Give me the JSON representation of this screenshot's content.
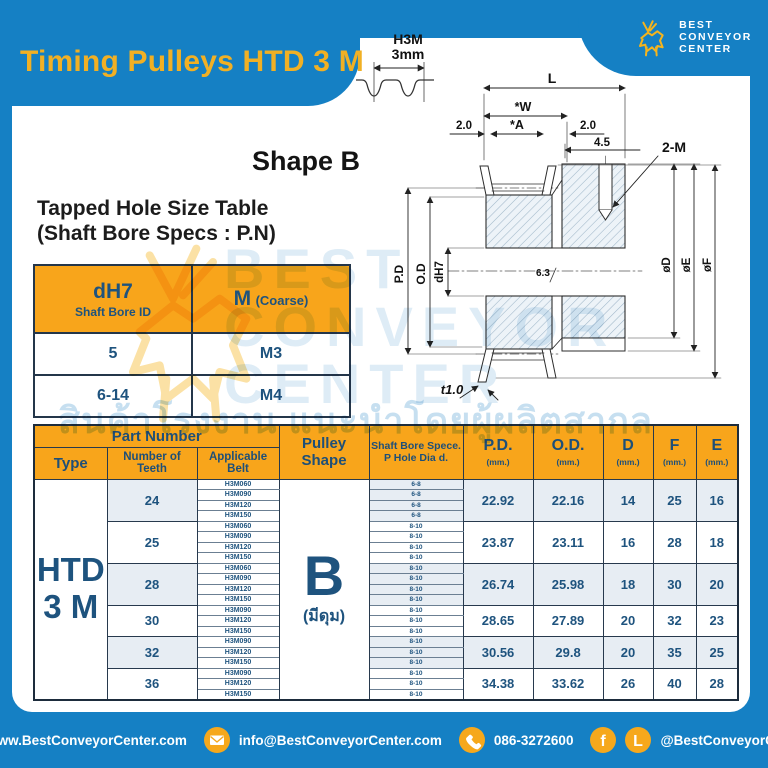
{
  "title": "Timing Pulleys HTD 3 M",
  "logo": {
    "line1": "BEST",
    "line2": "CONVEYOR",
    "line3": "CENTER"
  },
  "tooth_profile": {
    "type_label": "H3M",
    "pitch_label": "3mm"
  },
  "shape_heading": "Shape B",
  "tapped_hole_table": {
    "title1": "Tapped Hole Size Table",
    "title2": "(Shaft Bore Specs : P.N)",
    "col1_main": "dH7",
    "col1_sub": "Shaft Bore ID",
    "col2_main": "M",
    "col2_sub": "(Coarse)",
    "rows": [
      [
        "5",
        "M3"
      ],
      [
        "6-14",
        "M4"
      ]
    ]
  },
  "drawing": {
    "dim_L": "L",
    "dim_W": "*W",
    "dim_A": "*A",
    "dim_left": "2.0",
    "dim_right": "2.0",
    "dim_hub": "4.5",
    "tap_callout": "2-M",
    "pd": "P.D",
    "od": "O.D",
    "bore": "dH7",
    "surface": "6.3",
    "dia_d": "øD",
    "dia_e": "øE",
    "dia_f": "øF",
    "flange_t": "t1.0"
  },
  "main_table": {
    "header": {
      "part_number": "Part Number",
      "type": "Type",
      "teeth": "Number of Teeth",
      "belt": "Applicable Belt",
      "shape": "Pulley Shape",
      "bore1": "Shaft Bore Spece.",
      "bore2": "P Hole Dia d.",
      "pd": "P.D.",
      "od": "O.D.",
      "d": "D",
      "f": "F",
      "e": "E",
      "unit": "(mm.)"
    },
    "type_label": [
      "HTD",
      "3 M"
    ],
    "shape_letter": "B",
    "shape_note": "(มีดุม)",
    "groups": [
      {
        "teeth": "24",
        "belts": [
          "H3M060",
          "H3M090",
          "H3M120",
          "H3M150"
        ],
        "bores": [
          "6-8",
          "6-8",
          "6-8",
          "6-8"
        ],
        "pd": "22.92",
        "od": "22.16",
        "d": "14",
        "f": "25",
        "e": "16"
      },
      {
        "teeth": "25",
        "belts": [
          "H3M060",
          "H3M090",
          "H3M120",
          "H3M150"
        ],
        "bores": [
          "8-10",
          "8-10",
          "8-10",
          "8-10"
        ],
        "pd": "23.87",
        "od": "23.11",
        "d": "16",
        "f": "28",
        "e": "18"
      },
      {
        "teeth": "28",
        "belts": [
          "H3M060",
          "H3M090",
          "H3M120",
          "H3M150"
        ],
        "bores": [
          "8-10",
          "8-10",
          "8-10",
          "8-10"
        ],
        "pd": "26.74",
        "od": "25.98",
        "d": "18",
        "f": "30",
        "e": "20"
      },
      {
        "teeth": "30",
        "belts": [
          "H3M090",
          "H3M120",
          "H3M150"
        ],
        "bores": [
          "8-10",
          "8-10",
          "8-10"
        ],
        "pd": "28.65",
        "od": "27.89",
        "d": "20",
        "f": "32",
        "e": "23"
      },
      {
        "teeth": "32",
        "belts": [
          "H3M090",
          "H3M120",
          "H3M150"
        ],
        "bores": [
          "8-10",
          "8-10",
          "8-10"
        ],
        "pd": "30.56",
        "od": "29.8",
        "d": "20",
        "f": "35",
        "e": "25"
      },
      {
        "teeth": "36",
        "belts": [
          "H3M090",
          "H3M120",
          "H3M150"
        ],
        "bores": [
          "8-10",
          "8-10",
          "8-10"
        ],
        "pd": "34.38",
        "od": "33.62",
        "d": "26",
        "f": "40",
        "e": "28"
      }
    ]
  },
  "watermark": {
    "line1": "BEST",
    "line2": "CONVEYOR",
    "line3": "CENTER",
    "thai": "สินค้าโรงงาน แนะนำโดยผู้ผลิตสากล"
  },
  "footer": {
    "website": "www.BestConveyorCenter.com",
    "email": "info@BestConveyorCenter.com",
    "phone": "086-3272600",
    "social": "@BestConveyorCenter",
    "fb_glyph": "f",
    "line_glyph": "L"
  },
  "colors": {
    "blue": "#1580C4",
    "orange": "#F8A51B",
    "navy": "#1E537E",
    "yellow": "#F1B024",
    "shade": "#E7EDF3"
  }
}
